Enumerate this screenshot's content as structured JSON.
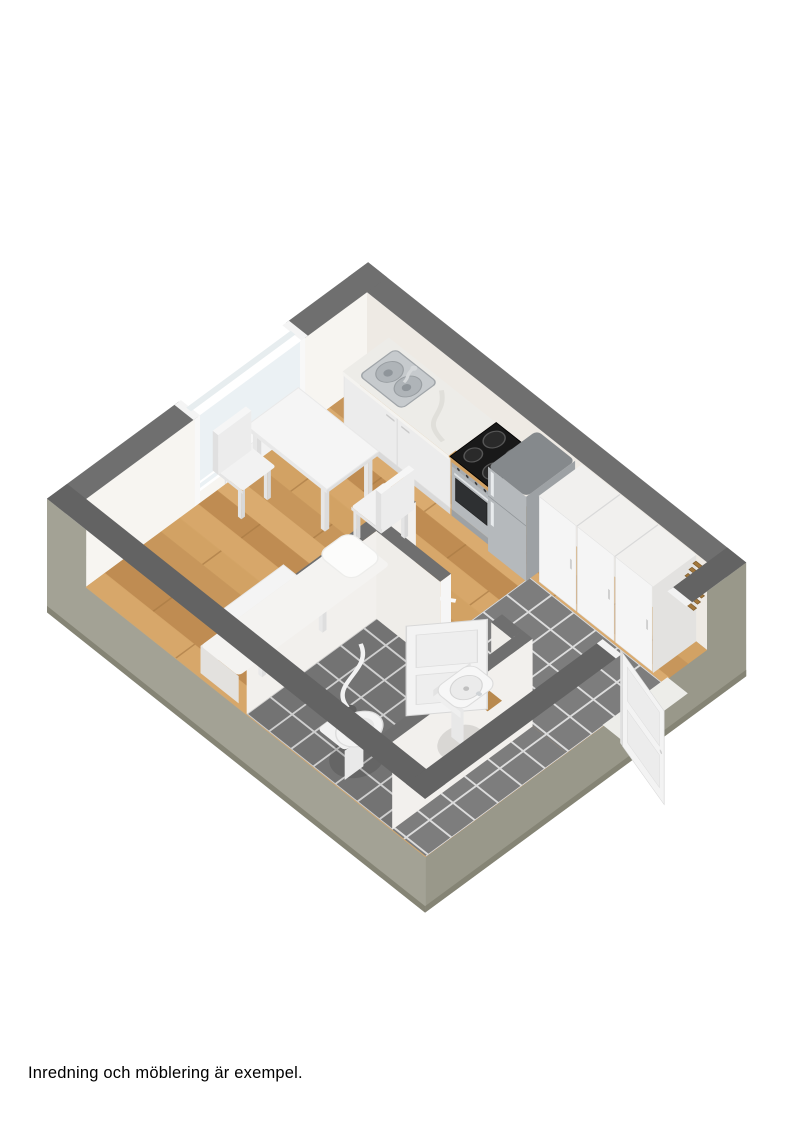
{
  "caption": {
    "text": "Inredning och möblering är exempel."
  },
  "scene": {
    "type": "3d-floorplan-render",
    "style": "isometric dollhouse cutaway, walls cut at ~1.3m",
    "rooms": [
      "main-room",
      "bathroom",
      "hallway"
    ],
    "objects": [
      "window",
      "radiator",
      "kitchen-counter",
      "kitchen-sink",
      "stove",
      "fridge",
      "wardrobes",
      "coat-rack",
      "dining-table",
      "dining-chair",
      "coffee-table",
      "bed",
      "bathroom-door",
      "bathroom-sink",
      "toilet",
      "shower",
      "front-door",
      "wood-floor",
      "tile-floor"
    ]
  },
  "colors": {
    "page_bg": "#ffffff",
    "wall_top": "#6f6f6f",
    "wall_top_dark": "#636363",
    "exterior_left": "#a3a295",
    "exterior_right": "#99988a",
    "exterior_base": "#858475",
    "wall_ne": "#eeeae4",
    "wall_nw": "#f7f5f1",
    "wall_white": "#f2f0ed",
    "wall_jamb": "#f6f6f6",
    "wood_base": "#cd9c5f",
    "wood_seam": "#a87a44",
    "wood_tone_a": "#d2a365",
    "wood_tone_b": "#c6955a",
    "wood_tone_c": "#dcae72",
    "wood_tone_d": "#bc8a50",
    "wood_tone_e": "#d8a96c",
    "threshold_wood": "#b8894e",
    "rack_wood": "#a2773c",
    "rack_wood_dark": "#7d5a2a",
    "tile_hall": "#7d7d7d",
    "tile_bath": "#737373",
    "grout": "#dcdcdc",
    "furn_top": "#f5f5f5",
    "furn_front": "#ececec",
    "furn_side": "#dcdcdc",
    "furn_stroke": "#e2e2e2",
    "steel": "#b5b9bc",
    "steel_side": "#9da1a4",
    "steel_top": "#85898c",
    "steel_hl": "#e8ebed",
    "counter_top": "#edece8",
    "sink_steel": "#c6cacd",
    "sink_bowl": "#afb4b8",
    "sink_edge": "#a0a5a9",
    "cooktop": "#191919",
    "burner": "#2a2a2a",
    "burner_ring": "#565656",
    "oven_glass": "#2e3032",
    "glass": "#e9f0f3",
    "white": "#fafafa",
    "caption": "#000000"
  }
}
